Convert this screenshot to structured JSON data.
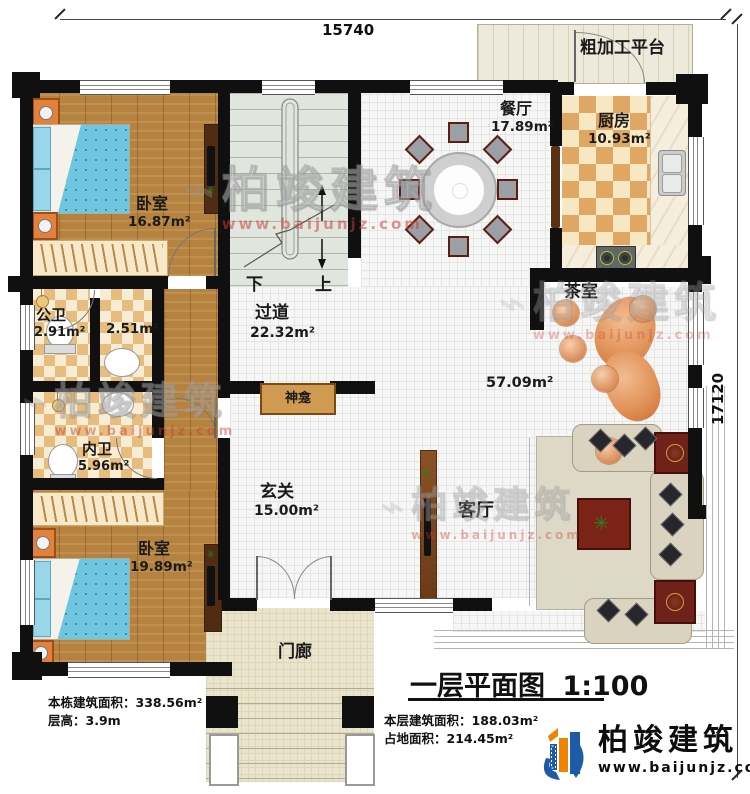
{
  "title_block": {
    "title": "一层平面图",
    "scale": "1:100"
  },
  "dimensions": {
    "top": "15740",
    "right": "17120"
  },
  "stats": {
    "building_area_label": "本栋建筑面积：",
    "building_area": "338.56m²",
    "floor_height_label": "层高：",
    "floor_height": "3.9m",
    "floor_area_label": "本层建筑面积：",
    "floor_area": "188.03m²",
    "footprint_label": "占地面积：",
    "footprint": "214.45m²"
  },
  "brand": {
    "name": "柏竣建筑",
    "url": "www.baijunjz.com"
  },
  "watermark": {
    "name": "柏竣建筑",
    "url": "www.baijunjz.com"
  },
  "rooms": {
    "platform": {
      "name": "粗加工平台"
    },
    "dining": {
      "name": "餐厅",
      "area": "17.89m²"
    },
    "kitchen": {
      "name": "厨房",
      "area": "10.93m²"
    },
    "bedroom1": {
      "name": "卧室",
      "area": "16.87m²"
    },
    "public_bath": {
      "name": "公卫",
      "area": "2.91m²"
    },
    "washroom": {
      "area": "2.51m²"
    },
    "corridor": {
      "name": "过道",
      "area": "22.32m²"
    },
    "tea_room": {
      "name": "茶室"
    },
    "hall_area": "57.09m²",
    "shrine": {
      "name": "神龛"
    },
    "inner_bath": {
      "name": "内卫",
      "area": "5.96m²"
    },
    "foyer": {
      "name": "玄关",
      "area": "15.00m²"
    },
    "bedroom2": {
      "name": "卧室",
      "area": "19.89m²"
    },
    "living": {
      "name": "客厅"
    },
    "porch": {
      "name": "门廊"
    },
    "stair": {
      "down": "下",
      "up": "上"
    }
  },
  "colors": {
    "wall": "#101010",
    "brand_blue": "#1e5ba6",
    "brand_orange": "#f08300",
    "watermark_red": "#c8473f"
  }
}
